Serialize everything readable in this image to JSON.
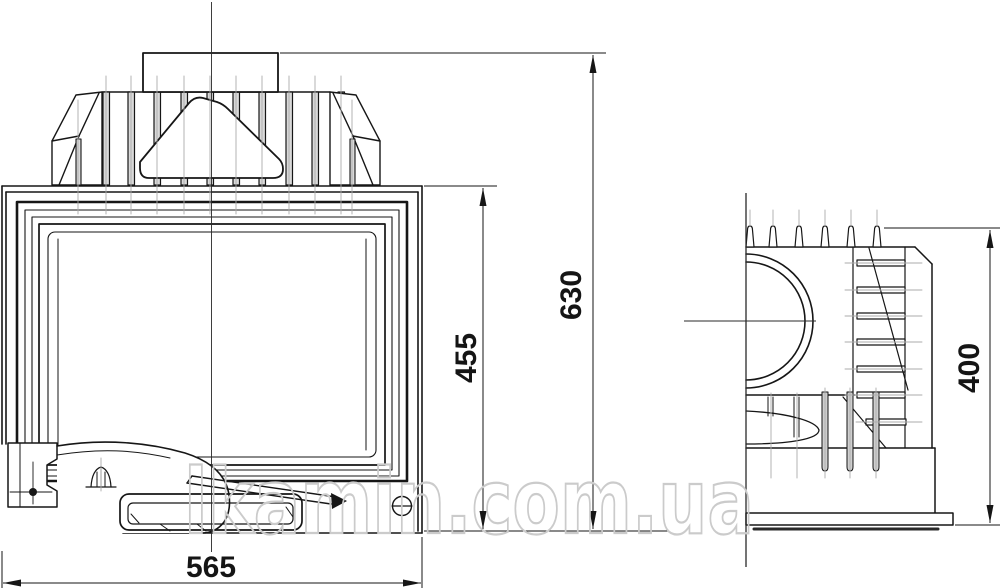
{
  "drawing": {
    "type": "technical-drawing",
    "subject": "fireplace insert, front and side orthographic views"
  },
  "dimensions": {
    "overall_width_mm": "565",
    "door_height_mm": "455",
    "overall_height_mm": "630",
    "overall_depth_mm": "400"
  },
  "watermark": {
    "text": "lkamin.com.ua"
  },
  "colors": {
    "line": "#161616",
    "construction_line": "#ababab",
    "fin_shading": "#d9d9d9",
    "watermark": "#cbcbcb",
    "background": "#ffffff"
  }
}
